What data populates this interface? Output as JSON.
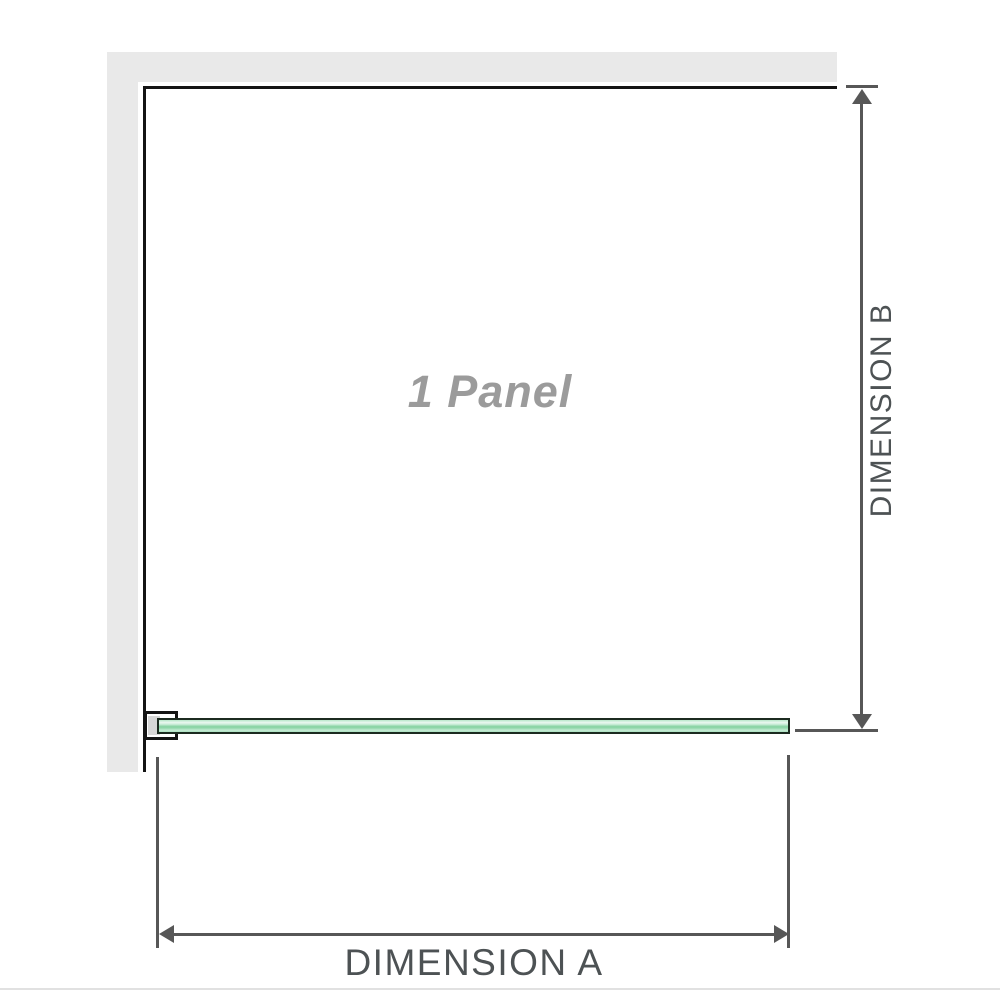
{
  "diagram": {
    "title": "1 Panel shower screen dimension diagram",
    "panel_label": "1 Panel",
    "dimension_a_label": "DIMENSION A",
    "dimension_b_label": "DIMENSION B"
  },
  "colors": {
    "wall_gray": "#e9e9e9",
    "panel_edge_black": "#141414",
    "arrow_gray": "#575757",
    "dimension_text_gray": "#4d5254",
    "panel_label_gray": "#9b9b9b",
    "glass_green_light": "#ebf8f1",
    "glass_green_mid": "#8dd5a7",
    "glass_border": "#1c2b20",
    "bracket_inner_gray": "#d7d7d7",
    "separator_gray": "#e1e1e1"
  }
}
